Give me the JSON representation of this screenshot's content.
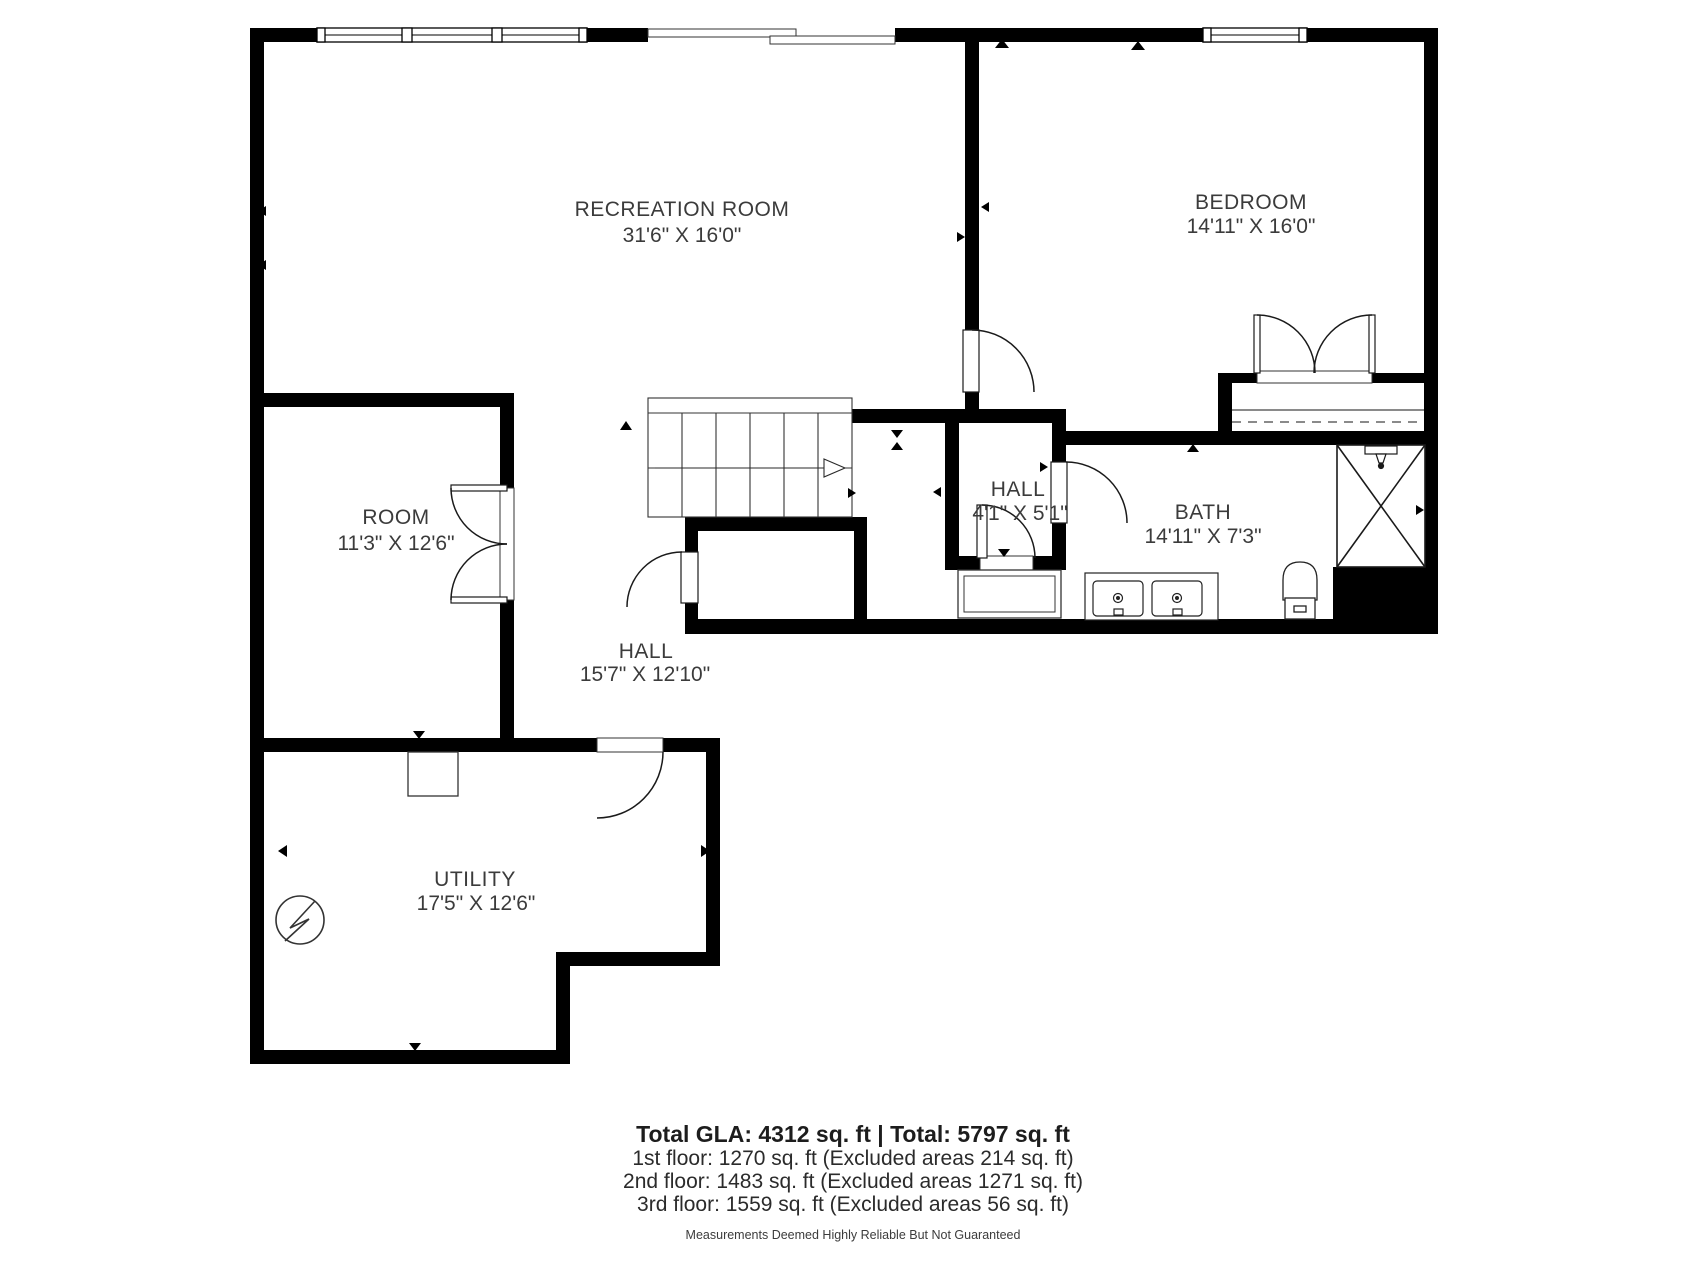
{
  "plan": {
    "rooms": [
      {
        "id": "recreation_room",
        "label": "RECREATION ROOM",
        "dims": "31'6\" X 16'0\""
      },
      {
        "id": "bedroom",
        "label": "BEDROOM",
        "dims": "14'11\" X 16'0\""
      },
      {
        "id": "room",
        "label": "ROOM",
        "dims": "11'3\" X 12'6\""
      },
      {
        "id": "hall_small",
        "label": "HALL",
        "dims": "4'1\" X 5'1\""
      },
      {
        "id": "bath",
        "label": "BATH",
        "dims": "14'11\" X 7'3\""
      },
      {
        "id": "hall",
        "label": "HALL",
        "dims": "15'7\" X 12'10\""
      },
      {
        "id": "utility",
        "label": "UTILITY",
        "dims": "17'5\" X 12'6\""
      }
    ],
    "fixtures": [
      "stairs-arrow",
      "shower",
      "toilet",
      "double-vanity",
      "electrical-symbol",
      "closet-rod"
    ]
  },
  "summary": {
    "total": "Total GLA: 4312 sq. ft | Total: 5797 sq. ft",
    "floors": [
      "1st floor: 1270 sq. ft (Excluded areas 214 sq. ft)",
      "2nd floor: 1483 sq. ft (Excluded areas 1271 sq. ft)",
      "3rd floor: 1559 sq. ft (Excluded areas 56 sq. ft)"
    ],
    "disclaimer": "Measurements Deemed Highly Reliable But Not Guaranteed"
  },
  "colors": {
    "wall": "#000000",
    "background": "#ffffff",
    "label_text": "#3b3b3b",
    "fixture_line": "#222222"
  }
}
